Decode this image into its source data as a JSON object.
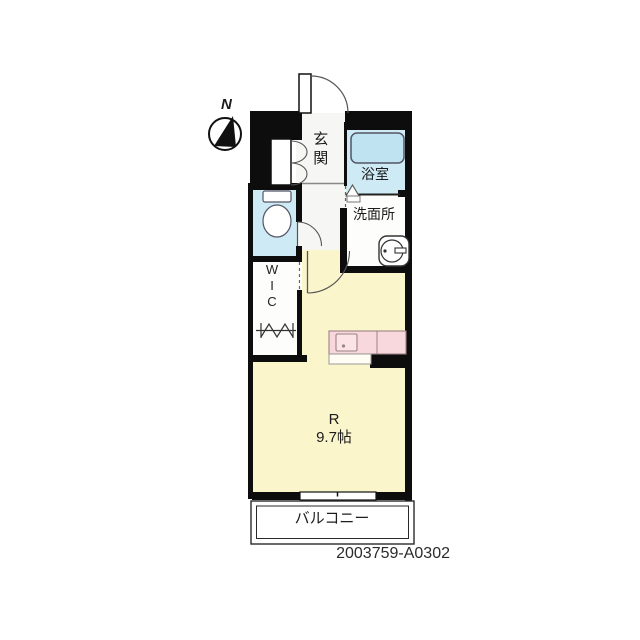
{
  "meta": {
    "code": "2003759-A0302"
  },
  "compass": {
    "label": "N"
  },
  "rooms": {
    "genkan": {
      "label": "玄関"
    },
    "bathroom": {
      "label": "浴室"
    },
    "washroom": {
      "label": "洗面所"
    },
    "wic": {
      "lines": [
        "W",
        "I",
        "C"
      ]
    },
    "main": {
      "label": "R",
      "size": "9.7帖"
    },
    "balcony": {
      "label": "バルコニー"
    }
  },
  "colors": {
    "wall": "#0d0d0d",
    "water_room_floor": "#cdeaf5",
    "bathtub": "#bfe3f1",
    "main_room_floor": "#fbf5cc",
    "kitchen_counter": "#f8d8dc",
    "hall_floor": "#f6f6f4"
  }
}
